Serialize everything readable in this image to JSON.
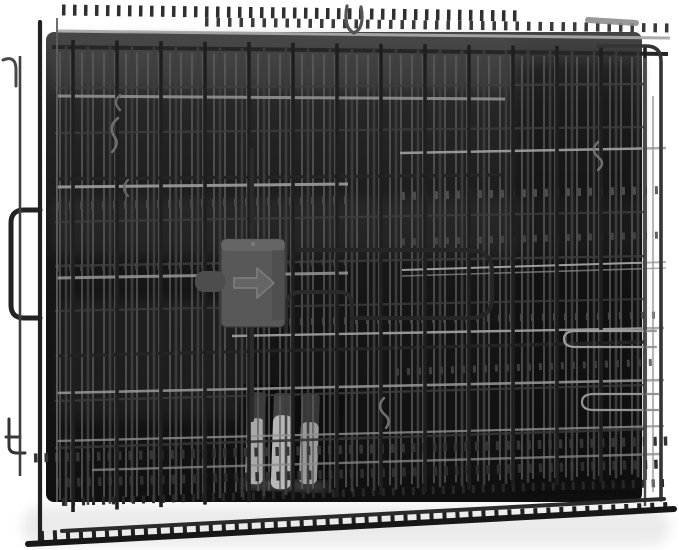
{
  "meta": {
    "description": "Product photo: black folded two-door wire dog crate with plastic tray, front view on white background",
    "width": 679,
    "height": 550
  },
  "palette": {
    "background": "#ffffff",
    "floor_shadow": "#dedede",
    "tray_highlight": "#454545",
    "tray_dark": "#101010",
    "wire_back": "#5f5f5f",
    "wire_mid": "#3e3e3e",
    "wire_front": "#1f1f1f",
    "wire_bright": "#a9a9a9",
    "latch_body": "#585858",
    "latch_tab": "#4d4d4d",
    "arrow_fill": "#666666",
    "arrow_edge": "#828282",
    "blade_light": "#b5b5b5",
    "blade_dark": "#383838"
  },
  "gradients": [
    {
      "id": "trayGrad",
      "x1": 0,
      "y1": 0,
      "x2": 0,
      "y2": 1,
      "stops": [
        [
          0,
          "#454545",
          1
        ],
        [
          0.16,
          "#262626",
          1
        ],
        [
          0.5,
          "#161616",
          1
        ],
        [
          1,
          "#101010",
          1
        ]
      ]
    }
  ],
  "scene": {
    "layers": [
      {
        "name": "background",
        "type": "rects",
        "items": [
          [
            0,
            0,
            679,
            550,
            0,
            "#ffffff",
            1,
            false,
            "background"
          ]
        ]
      },
      {
        "name": "floor-shadow",
        "type": "rects",
        "items": [
          [
            22,
            506,
            648,
            40,
            20,
            "#dedede",
            0.6,
            true,
            "floor-shadow"
          ]
        ]
      },
      {
        "name": "crate-tray",
        "type": "rects",
        "items": [
          [
            46,
            32,
            596,
            470,
            8,
            "url(#trayGrad)",
            1,
            false,
            "crate-tray-pan"
          ],
          [
            54,
            36,
            460,
            52,
            6,
            "#585858",
            0.28,
            true,
            "tray-top-sheen"
          ],
          [
            52,
            198,
            588,
            58,
            4,
            "#8a8a8a",
            0.1,
            true,
            "tray-mid-reflection"
          ],
          [
            58,
            300,
            190,
            120,
            8,
            "#6a6a6a",
            0.12,
            true,
            "tray-lower-sheen"
          ],
          [
            520,
            60,
            120,
            430,
            6,
            "#0b0b0b",
            0.45,
            true,
            "tray-right-shade"
          ]
        ]
      },
      {
        "name": "carry-handle-blades",
        "type": "rects",
        "transform": "translate(248,392) rotate(2)",
        "items": [
          [
            -8,
            -8,
            104,
            106,
            4,
            "#0d0d0d",
            1,
            false,
            "handle-recess"
          ],
          [
            0,
            0,
            18,
            34,
            3,
            "#3c3c3c",
            1,
            false,
            "handle-blade"
          ],
          [
            0,
            26,
            18,
            66,
            6,
            "#a9a9a9",
            1,
            false,
            "handle-blade"
          ],
          [
            26,
            0,
            20,
            30,
            3,
            "#424242",
            1,
            false,
            "handle-blade"
          ],
          [
            26,
            22,
            20,
            74,
            7,
            "#b5b5b5",
            1,
            false,
            "handle-blade"
          ],
          [
            54,
            0,
            18,
            36,
            3,
            "#383838",
            1,
            false,
            "handle-blade"
          ],
          [
            54,
            28,
            18,
            62,
            6,
            "#9a9a9a",
            1,
            false,
            "handle-blade"
          ],
          [
            -2,
            88,
            84,
            8,
            4,
            "#c8c8c8",
            0.45,
            true,
            "handle-glint"
          ]
        ]
      },
      {
        "name": "wire-grid-back",
        "type": "vgrid",
        "grid": {
          "x1": 60,
          "x2": 641,
          "step": 11,
          "w": 1.7,
          "c": "#5f5f5f",
          "o": 0.85,
          "yT1": 52,
          "yT2": 57,
          "yB1": 500,
          "yB2": 474
        }
      },
      {
        "name": "dark-horizontal-wires",
        "type": "lines",
        "items": [
          [
            52,
            47,
            668,
            54,
            4,
            "#262626",
            1,
            null,
            "butt"
          ],
          [
            55,
            88,
            645,
            84,
            2.4,
            "#3e3e3e",
            0.9,
            null,
            "butt"
          ],
          [
            55,
            133,
            645,
            127,
            2.2,
            "#3e3e3e",
            0.8,
            null,
            "butt"
          ],
          [
            55,
            179,
            502,
            175,
            3.2,
            "#242424",
            1,
            null,
            "butt"
          ],
          [
            55,
            222,
            645,
            212,
            2.2,
            "#3e3e3e",
            0.8,
            null,
            "butt"
          ],
          [
            55,
            266,
            645,
            256,
            2.4,
            "#3a3a3a",
            0.9,
            null,
            "butt"
          ],
          [
            55,
            311,
            645,
            299,
            2.2,
            "#3e3e3e",
            0.75,
            null,
            "butt"
          ],
          [
            55,
            356,
            645,
            342,
            3.2,
            "#242424",
            0.95,
            null,
            "butt"
          ],
          [
            55,
            401,
            645,
            385,
            2.2,
            "#3e3e3e",
            0.8,
            null,
            "butt"
          ],
          [
            55,
            448,
            645,
            429,
            2.6,
            "#353535",
            0.9,
            null,
            "butt"
          ]
        ]
      },
      {
        "name": "mesh-edge-rows",
        "type": "lines",
        "items": [
          [
            62,
            10,
            522,
            16,
            11,
            "#2f2f2f",
            1,
            "3.5,7.5",
            "butt"
          ],
          [
            205,
            22,
            670,
            28,
            9,
            "#3a3a3a",
            1,
            "3.5,8",
            "butt"
          ],
          [
            58,
            206,
            346,
            200,
            8,
            "#4a4a4a",
            0.9,
            "3,8",
            "butt"
          ],
          [
            402,
            196,
            664,
            190,
            8,
            "#515151",
            0.9,
            "3,8",
            "butt"
          ],
          [
            402,
            242,
            664,
            235,
            7,
            "#474747",
            0.85,
            "3,8",
            "butt"
          ],
          [
            58,
            268,
            346,
            262,
            7,
            "#444444",
            0.8,
            "3,8",
            "butt"
          ],
          [
            234,
            323,
            662,
            315,
            7,
            "#4c4c4c",
            0.85,
            "3,8",
            "butt"
          ],
          [
            396,
            372,
            662,
            362,
            7,
            "#484848",
            0.8,
            "3,8",
            "butt"
          ],
          [
            34,
            458,
            668,
            441,
            9,
            "#343434",
            1,
            "3.5,7",
            "butt"
          ],
          [
            56,
            483,
            662,
            464,
            9,
            "#2e2e2e",
            1,
            "3.5,7",
            "butt"
          ],
          [
            62,
            502,
            664,
            483,
            8,
            "#272727",
            1,
            "3,7",
            "butt"
          ],
          [
            40,
            536,
            668,
            507,
            10,
            "#202020",
            1,
            "4,9",
            "butt"
          ]
        ]
      },
      {
        "name": "wire-grid-mid",
        "type": "vgrid",
        "grid": {
          "x1": 66,
          "x2": 644,
          "step": 22,
          "w": 2.6,
          "c": "#3e3e3e",
          "o": 0.95,
          "yT1": 46,
          "yT2": 52,
          "yB1": 506,
          "yB2": 477
        }
      },
      {
        "name": "bright-horizontal-rails",
        "type": "lines",
        "items": [
          [
            56,
            31,
            670,
            38,
            3,
            "#a9a9a9",
            0.95,
            null,
            "butt"
          ],
          [
            58,
            96,
            505,
            99,
            3,
            "#969696",
            0.85,
            null,
            "butt"
          ],
          [
            400,
            153,
            666,
            148,
            2.5,
            "#a2a2a2",
            0.9,
            null,
            "butt"
          ],
          [
            56,
            187,
            348,
            184,
            3,
            "#9e9e9e",
            0.9,
            null,
            "butt"
          ],
          [
            402,
            270,
            666,
            262,
            2,
            "#aaaaaa",
            0.9,
            null,
            "butt"
          ],
          [
            402,
            276,
            666,
            268,
            1.6,
            "#8f8f8f",
            0.7,
            null,
            "butt"
          ],
          [
            56,
            278,
            348,
            273,
            3,
            "#989898",
            0.85,
            null,
            "butt"
          ],
          [
            232,
            336,
            664,
            328,
            2.4,
            "#a3a3a3",
            0.9,
            null,
            "butt"
          ],
          [
            56,
            393,
            664,
            380,
            2.6,
            "#9a9a9a",
            0.85,
            null,
            "butt"
          ],
          [
            56,
            441,
            664,
            426,
            2.2,
            "#909090",
            0.8,
            null,
            "butt"
          ],
          [
            92,
            470,
            660,
            454,
            2.4,
            "#8a8a8a",
            0.75,
            null,
            "butt"
          ],
          [
            588,
            20,
            636,
            23,
            6,
            "#8f8f8f",
            0.9,
            null,
            "round"
          ]
        ]
      },
      {
        "name": "wire-grid-front",
        "type": "vgrid",
        "grid": {
          "x1": 73,
          "x2": 645,
          "step": 44,
          "w": 3.6,
          "c": "#1f1f1f",
          "o": 1,
          "yT1": 40,
          "yT2": 47,
          "yB1": 512,
          "yB2": 480
        }
      },
      {
        "name": "wire-hooks-and-loops",
        "type": "paths",
        "items": [
          [
            "M 252 150 V 420",
            4,
            "#2b2b2b",
            1,
            "latch-guide-rod"
          ],
          [
            "M 40 210 H 24 Q 11 210 11 223 V 305 Q 11 318 24 318 H 40",
            5,
            "#232323",
            1,
            "side-handle-loop"
          ],
          [
            "M 3 60 Q 15 55 16 68 V 86",
            3,
            "#474747",
            1,
            "corner-hook"
          ],
          [
            "M 9 419 V 446 Q 9 453 17 453 H 25",
            3,
            "#333333",
            1,
            "corner-hook"
          ],
          [
            "M 6 437 H 20",
            3,
            "#3a3a3a",
            1,
            "corner-hook"
          ],
          [
            "M 347 6 Q 343 28 354 33 Q 365 28 361 7",
            3.2,
            "#555555",
            1,
            "top-hanger-loop"
          ],
          [
            "M 286 330 V 308 Q 286 292 302 292 H 338 Q 352 292 352 306 V 330",
            4,
            "#2a2a2a",
            1,
            "door-edge-hairpin"
          ],
          [
            "M 300 250 H 468 Q 492 250 492 272 V 298 Q 492 318 470 318 H 352",
            4,
            "#262626",
            1,
            "door-edge-loop"
          ],
          [
            "M 598 142 Q 590 150 598 157 Q 606 163 598 170",
            2.5,
            "#787878",
            0.9,
            "wire-squiggle"
          ],
          [
            "M 656 331 H 576 Q 564 331 564 339 Q 564 347 576 347 H 656",
            2.2,
            "#9c9c9c",
            1,
            "bright-hairpin"
          ],
          [
            "M 658 394 H 594 Q 582 394 582 402 Q 582 410 594 410 H 658",
            2.2,
            "#949494",
            1,
            "bright-hairpin"
          ],
          [
            "M 118 118 Q 108 126 114 136 Q 120 144 112 152",
            2.5,
            "#6f6f6f",
            1,
            "wire-squiggle"
          ],
          [
            "M 128 180 Q 120 188 128 196",
            2.2,
            "#666666",
            1,
            "wire-squiggle"
          ],
          [
            "M 120 95 Q 112 102 120 110",
            2.4,
            "#6a6a6a",
            1,
            "wire-squiggle"
          ],
          [
            "M 384 398 Q 376 406 384 414 Q 392 420 386 428",
            2.5,
            "#707070",
            1,
            "wire-squiggle"
          ],
          [
            "M 598 46 H 646 Q 661 46 661 61 V 500",
            3.6,
            "#343434",
            1,
            "right-frame-corner"
          ]
        ]
      },
      {
        "name": "frame-edges",
        "type": "lines",
        "items": [
          [
            20,
            56,
            20,
            476,
            2.6,
            "#3f3f3f",
            1,
            null,
            "butt"
          ],
          [
            40,
            22,
            40,
            541,
            4.2,
            "#212121",
            1,
            null,
            "round"
          ],
          [
            57,
            18,
            57,
            502,
            2,
            "#606060",
            0.9,
            null,
            "butt"
          ],
          [
            645,
            58,
            645,
            506,
            2.4,
            "#4a4a4a",
            1,
            null,
            "butt"
          ],
          [
            653,
            96,
            653,
            492,
            1.6,
            "#909090",
            0.8,
            null,
            "butt"
          ],
          [
            28,
            544,
            674,
            509,
            6,
            "#171717",
            1,
            null,
            "round"
          ],
          [
            62,
            531,
            664,
            499,
            4,
            "#2b2b2b",
            1,
            null,
            "round"
          ]
        ]
      },
      {
        "name": "latch-slider",
        "type": "latch",
        "latch": {
          "body": [
            221,
            239,
            64,
            88,
            5,
            "#585858",
            "#3a3a3a"
          ],
          "bevel": [
            221,
            239,
            64,
            12,
            5,
            "#717171",
            0.5
          ],
          "shade": [
            272,
            250,
            12,
            70,
            0,
            "#454545",
            0.5
          ],
          "tab": [
            195,
            271,
            30,
            21,
            9,
            "#4d4d4d"
          ],
          "screw": [
            253,
            244,
            2,
            "#7c7c7c"
          ],
          "arrow_points": "234,278 257,278 257,268 274,283 257,298 257,288 234,288",
          "arrow_fill": "#666666",
          "arrow_edge": "#828282"
        }
      }
    ]
  }
}
